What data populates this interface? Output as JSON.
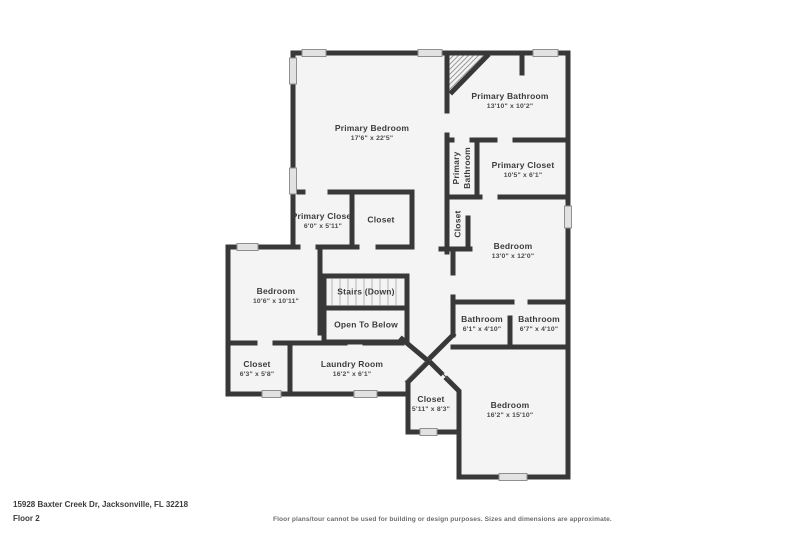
{
  "page": {
    "address": "15928 Baxter Creek Dr, Jacksonville, FL 32218",
    "floor_label": "Floor 2",
    "disclaimer": "Floor plans/tour cannot be used for building or design purposes. Sizes and dimensions are approximate."
  },
  "colors": {
    "wall": "#383838",
    "floor_fill": "#f4f4f4",
    "window_fill": "#e2e2e2",
    "window_border": "#8f8f8f",
    "background": "#ffffff"
  },
  "rooms": {
    "primary_bedroom": {
      "name": "Primary Bedroom",
      "dims": "17'6\" x 22'5\""
    },
    "primary_bathroom": {
      "name": "Primary Bathroom",
      "dims": "13'10\" x 10'2\""
    },
    "primary_bathroom_wc": {
      "name": "Primary Bathroom",
      "dims": ""
    },
    "primary_closet": {
      "name": "Primary Closet",
      "dims": "10'5\" x 6'1\""
    },
    "primary_closet_2": {
      "name": "Primary Closet",
      "dims": "6'0\" x 5'11\""
    },
    "closet_a": {
      "name": "Closet",
      "dims": ""
    },
    "closet_b": {
      "name": "Closet",
      "dims": ""
    },
    "bedroom_2": {
      "name": "Bedroom",
      "dims": "13'0\" x 12'0\""
    },
    "bathroom_1": {
      "name": "Bathroom",
      "dims": "6'1\" x 4'10\""
    },
    "bathroom_2": {
      "name": "Bathroom",
      "dims": "6'7\" x 4'10\""
    },
    "bedroom_3": {
      "name": "Bedroom",
      "dims": "10'6\" x 10'11\""
    },
    "stairs": {
      "name": "Stairs (Down)",
      "dims": ""
    },
    "open_to_below": {
      "name": "Open To Below",
      "dims": ""
    },
    "closet_c": {
      "name": "Closet",
      "dims": "6'3\" x 5'8\""
    },
    "laundry": {
      "name": "Laundry Room",
      "dims": "16'2\" x 6'1\""
    },
    "closet_d": {
      "name": "Closet",
      "dims": "5'11\" x 8'3\""
    },
    "bedroom_4": {
      "name": "Bedroom",
      "dims": "16'2\" x 15'10\""
    }
  }
}
